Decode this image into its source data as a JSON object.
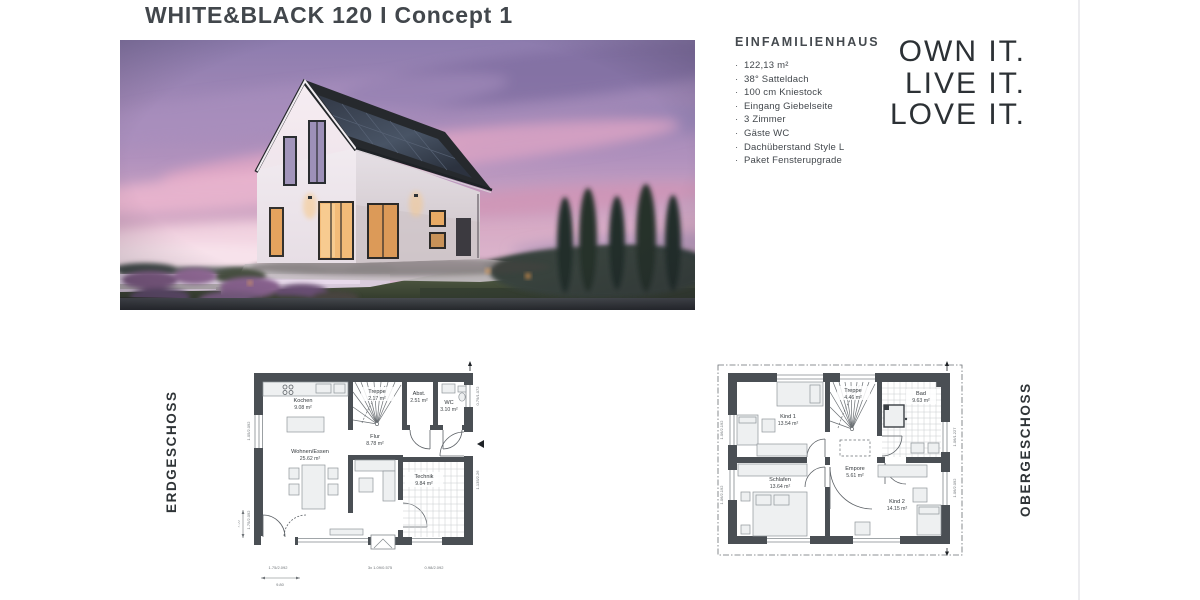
{
  "page": {
    "title": "WHITE&BLACK 120 I Concept 1"
  },
  "specs": {
    "heading": "EINFAMILIENHAUS",
    "items": [
      "122,13 m²",
      "38° Satteldach",
      "100 cm Kniestock",
      "Eingang Giebelseite",
      "3 Zimmer",
      "Gäste WC",
      "Dachüberstand Style L",
      "Paket Fensterupgrade"
    ]
  },
  "tagline": {
    "line1": "OWN IT.",
    "line2": "LIVE IT.",
    "line3": "LOVE IT."
  },
  "floorplans": {
    "eg": {
      "label": "ERDGESCHOSS",
      "rooms": {
        "kochen": {
          "name": "Kochen",
          "area": "9.08 m²"
        },
        "treppe": {
          "name": "Treppe",
          "area": "2.17 m²"
        },
        "abst": {
          "name": "Abst.",
          "area": "2.51 m²"
        },
        "wc": {
          "name": "WC",
          "area": "3.10 m²"
        },
        "flur": {
          "name": "Flur",
          "area": "8.78 m²"
        },
        "wohnen": {
          "name": "Wohnen/Essen",
          "area": "25.62 m²"
        },
        "technik": {
          "name": "Technik",
          "area": "9.84 m²"
        }
      },
      "dims": {
        "b1": "1.75/2.092",
        "b2": "3x 1.09/0.575",
        "b3": "0.98/2.092",
        "b4": "9.80",
        "l1": "1.05/2.092",
        "l2": "1.75/2.092",
        "l3": "7.55",
        "r1": "0.79/1.072",
        "r2": "1.135/2.26"
      }
    },
    "og": {
      "label": "OBERGESCHOSS",
      "rooms": {
        "kind1": {
          "name": "Kind 1",
          "area": "13.54 m²"
        },
        "treppe": {
          "name": "Treppe",
          "area": "4.46 m²"
        },
        "bad": {
          "name": "Bad",
          "area": "9.63 m²"
        },
        "empore": {
          "name": "Empore",
          "area": "5.61 m²"
        },
        "schlafen": {
          "name": "Schlafen",
          "area": "13.64 m²"
        },
        "kind2": {
          "name": "Kind 2",
          "area": "14.15 m²"
        }
      },
      "dims": {
        "l1": "1.06/2.192",
        "l2": "1.06/2.192",
        "r1": "1.06/1.227",
        "r2": "1.06/2.092"
      }
    }
  },
  "colors": {
    "plan_wall": "#4a4f54",
    "sky_top": "#8d7cae",
    "sky_pink": "#e5a8c6",
    "roof": "#26292d",
    "window_glow": "#f2bb78",
    "accent_text": "#2c3135"
  }
}
